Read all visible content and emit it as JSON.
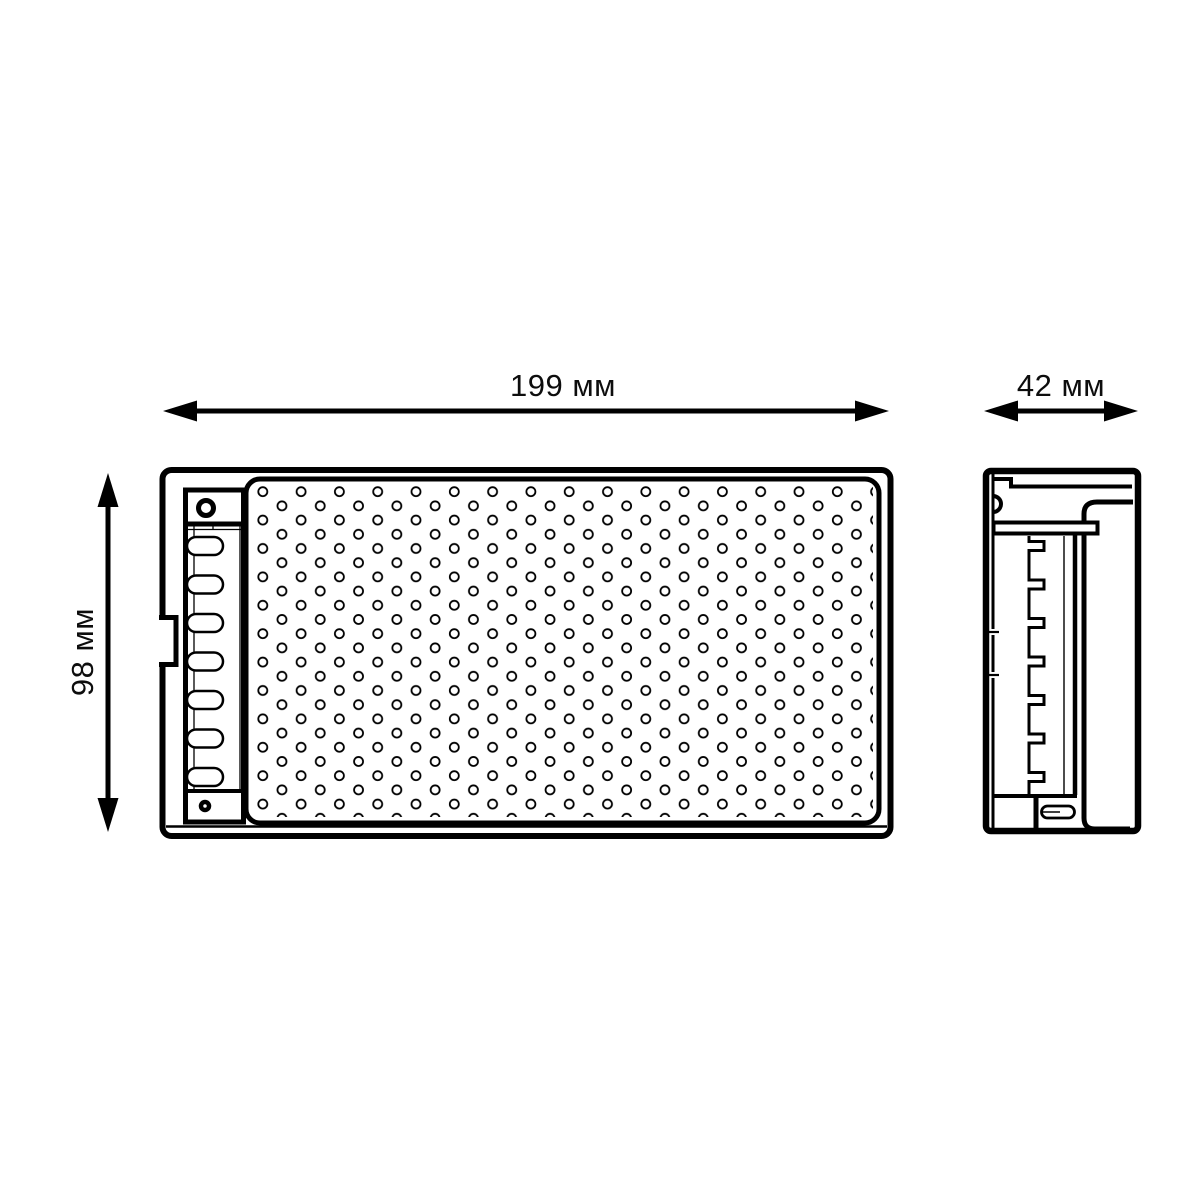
{
  "canvas": {
    "background": "#ffffff",
    "line_color": "#000000"
  },
  "drawing": {
    "type": "technical-dimension-drawing",
    "views": {
      "front": {
        "name": "front view (perforated enclosure with terminal strip)"
      },
      "side": {
        "name": "side view (mounting profile)"
      }
    }
  },
  "dimensions": {
    "front_width": {
      "value": "199",
      "unit": "мм",
      "label": "199 мм"
    },
    "side_depth": {
      "value": "42",
      "unit": "мм",
      "label": "42 мм"
    },
    "front_height": {
      "value": "98",
      "unit": "мм",
      "label": "98 мм"
    }
  }
}
